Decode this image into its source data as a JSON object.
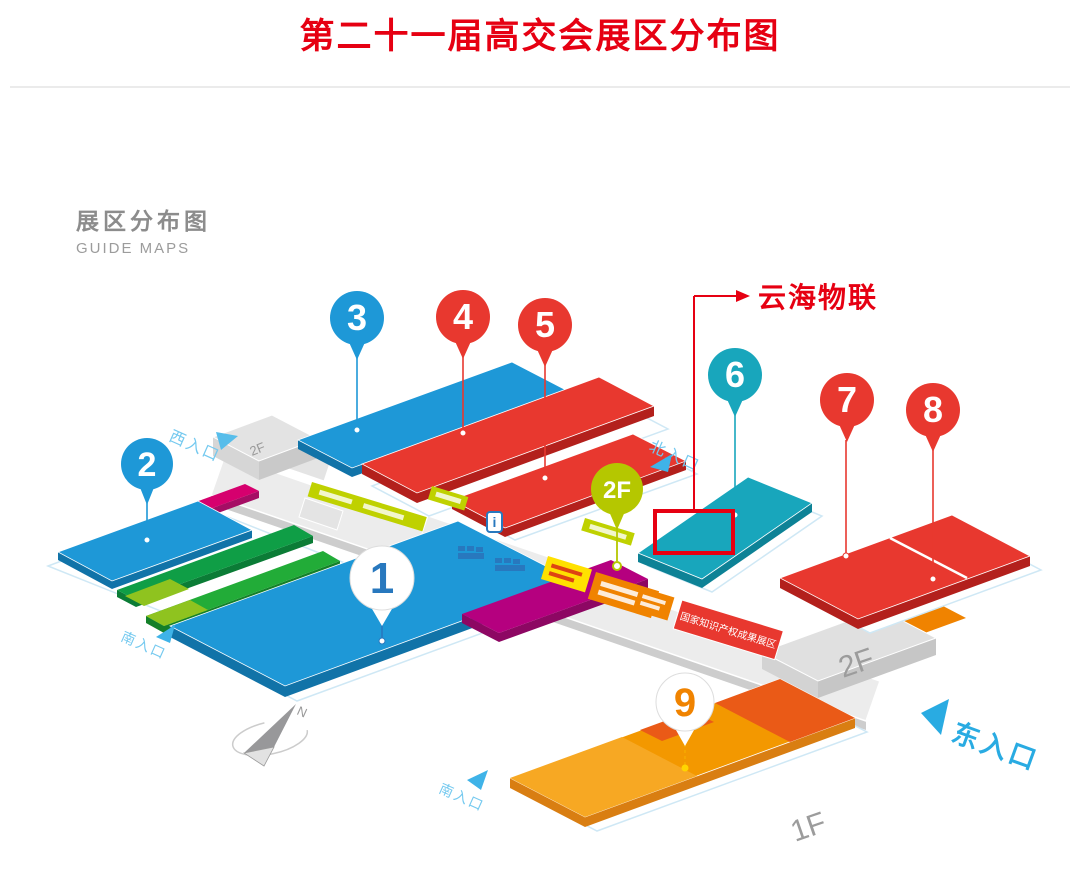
{
  "page": {
    "title": "第二十一届高交会展区分布图"
  },
  "guide": {
    "title_zh": "展区分布图",
    "title_en": "GUIDE MAPS"
  },
  "annotation": {
    "label": "云海物联"
  },
  "entrances": {
    "west": "西入口",
    "north": "北入口",
    "south_left": "南入口",
    "south_bottom": "南入口",
    "east": "东入口"
  },
  "floors": {
    "left_wing_2f": "2F",
    "right_wing_2f": "2F",
    "ground_1f": "1F"
  },
  "pins": {
    "p1": "1",
    "p2": "2",
    "p3": "3",
    "p4": "4",
    "p5": "5",
    "p6": "6",
    "p7": "7",
    "p8": "8",
    "p9": "9",
    "p2f": "2F"
  },
  "labels": {
    "corridor_red_strip": "国家知识产权成果展区",
    "info_icon": "i"
  },
  "compass": {
    "north": "N"
  },
  "palette": {
    "accent_red": "#e60012",
    "pin_blue": "#1e98d7",
    "pin_red": "#e8382f",
    "pin_teal": "#18a6bc",
    "pin_green": "#b5c700",
    "hall_orange": "#f39800",
    "hall_magenta": "#d6006e",
    "hall_green": "#22ac38",
    "lime_strip": "#bfd100",
    "entrance_blue": "#29abe2",
    "corridor_gray": "#ececec"
  }
}
